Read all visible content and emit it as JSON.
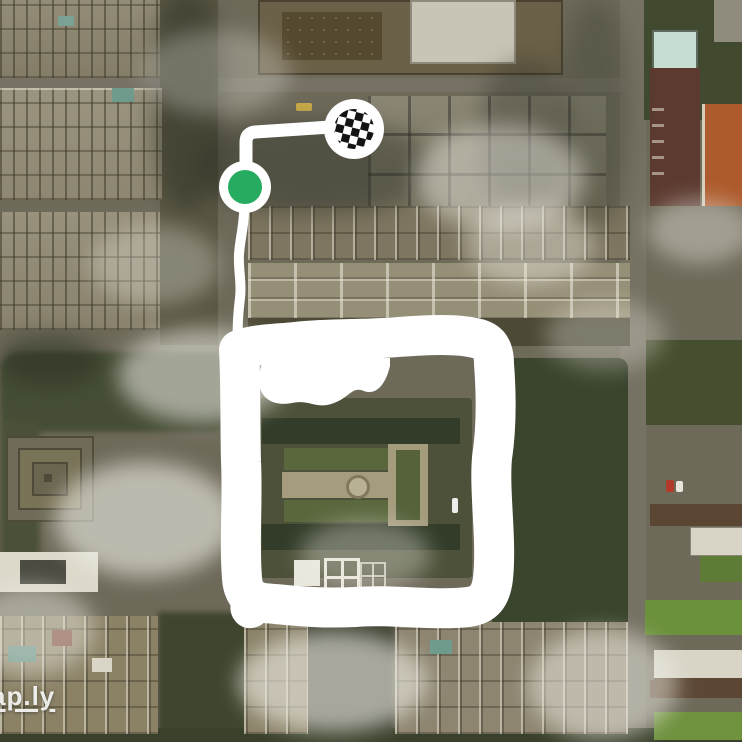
{
  "map": {
    "imagery": "satellite",
    "watermark": "ap.ly"
  },
  "colors": {
    "route": "#ffffff",
    "marker_ring": "#ffffff",
    "start_green": "#25ac60",
    "checker_black": "#141414",
    "checker_white": "#ffffff"
  },
  "route": {
    "stroke_widths": {
      "line": 13,
      "tail": 10,
      "loop": 40
    },
    "paths": {
      "to_finish": "M246 187 L246 142 Q246 133 255 132 L331 127",
      "below_start": "M244 187 L244 214 C243 230 240 240 239 254 C238 270 242 282 240 298 C238 314 237 330 238 346",
      "loop": "M239 350 C255 344 275 344 295 342 C330 338 365 340 398 337 C426 335 458 333 479 339 C491 343 494 352 494 364 C496 390 497 425 492 458 C489 492 497 540 493 578 C491 596 484 605 468 607 C432 611 394 604 355 607 C318 609 288 605 264 603 C250 601 243 593 242 578 C239 540 243 500 241 462 C240 422 241 388 239 350 Z",
      "inner_blob": "M262 364 C252 390 266 408 292 403 C310 399 316 410 334 403 C350 397 352 386 364 391 C377 396 386 383 390 366 L390 358 L262 358 Z",
      "corner_bulge": "M232 600 C226 614 238 630 252 628 C268 626 272 612 264 600 Z"
    },
    "start_marker": {
      "icon": "green-dot",
      "cx": 245,
      "cy": 187,
      "outer_r": 26,
      "inner_r": 17
    },
    "finish_marker": {
      "icon": "checkered-flag",
      "cx": 354,
      "cy": 129,
      "outer_r": 30,
      "checker_r": 20
    }
  }
}
